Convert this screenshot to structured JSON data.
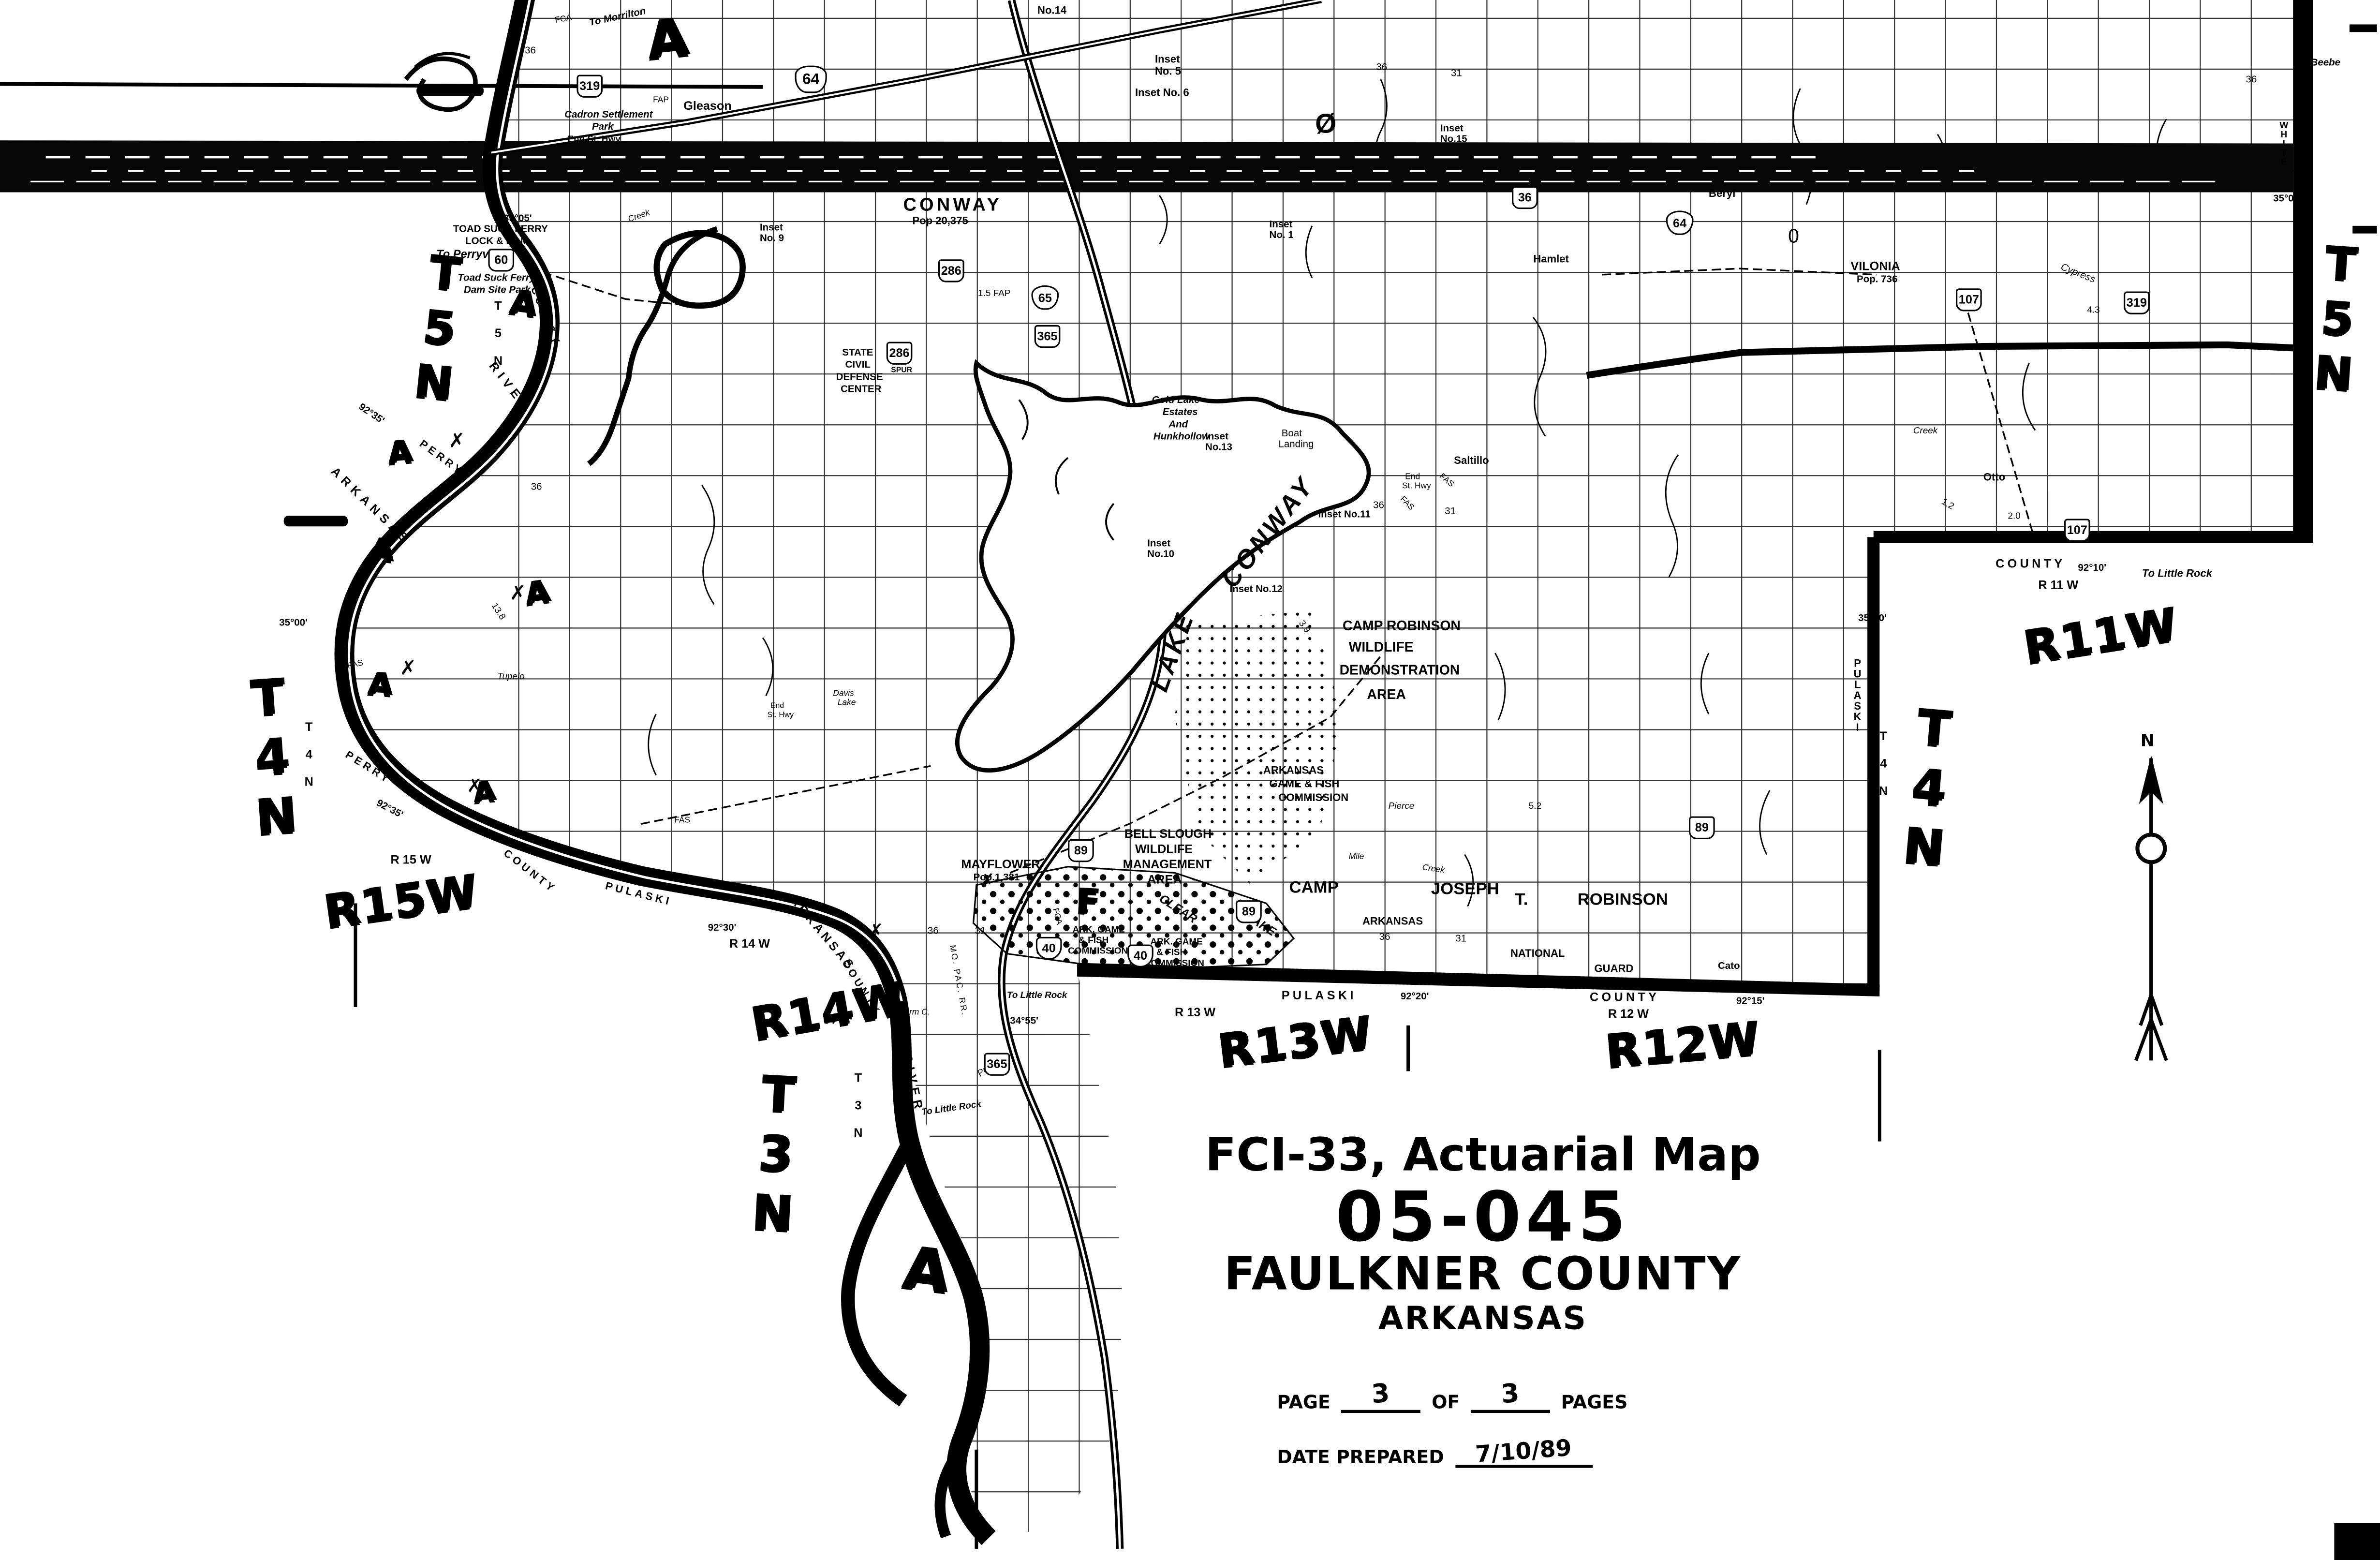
{
  "title_block": {
    "line1": "FCI-33, Actuarial Map",
    "map_number": "05-045",
    "county": "FAULKNER COUNTY",
    "state": "ARKANSAS",
    "page_label": "PAGE",
    "page_current": "3",
    "of_label": "OF",
    "page_total": "3",
    "pages_label": "PAGES",
    "date_label": "DATE PREPARED",
    "date_value": "7/10/89"
  },
  "compass": {
    "north": "N"
  },
  "towns": {
    "conway": "CONWAY",
    "conway_pop": "Pop 20,375",
    "vilonia": "VILONIA",
    "vilonia_pop": "Pop. 736",
    "mayflower": "MAYFLOWER",
    "mayflower_pop": "Pop.1,381",
    "gleason": "Gleason",
    "saltillo": "Saltillo",
    "otto": "Otto",
    "hamlet": "Hamlet",
    "beryl": "Beryl",
    "cato": "Cato"
  },
  "areas": {
    "camp_robinson_wda": [
      "CAMP ROBINSON",
      "WILDLIFE",
      "DEMONSTRATION",
      "AREA"
    ],
    "agfc_lake": [
      "ARKANSAS",
      "GAME & FISH",
      "COMMISSION"
    ],
    "agfc_south": [
      "ARK. GAME",
      "& FISH",
      "COMMISSION"
    ],
    "bell_slough": [
      "BELL SLOUGH",
      "WILDLIFE",
      "MANAGEMENT",
      "AREA"
    ],
    "camp_joseph": {
      "camp": "CAMP",
      "joseph": "JOSEPH",
      "t": "T.",
      "robinson": "ROBINSON",
      "arkansas": "ARKANSAS",
      "national": "NATIONAL",
      "guard": "GUARD"
    },
    "state_civil_defense": [
      "STATE",
      "CIVIL",
      "DEFENSE",
      "CENTER"
    ],
    "gold_lake": [
      "Gold Lake",
      "Estates",
      "And",
      "Hunkhollow"
    ],
    "cadron": [
      "Cadron Settlement",
      "Park"
    ],
    "toad_suck": [
      "TOAD SUCK FERRY",
      "LOCK & DAM"
    ],
    "toad_suck_park": [
      "Toad Suck Ferry",
      "Dam Site Park"
    ],
    "boat_landing": [
      "Boat",
      "Landing"
    ],
    "davis_lake": [
      "Davis",
      "Lake"
    ],
    "end_st_hwy2": [
      "End",
      "St. Hwy"
    ]
  },
  "water": {
    "lake": "LAKE",
    "conway": "CONWAY",
    "clear": "CLEAR",
    "clear_lake_word": "LAKE",
    "arkansas": "ARKANSAS",
    "river": "RIVER",
    "pierce": "Pierce",
    "mile": "Mile",
    "creek": "Creek",
    "palarm": "Palarm",
    "palarm_c": "Palarm C.",
    "tupelo": "Tupelo",
    "cypress": "Cypress"
  },
  "counties": {
    "perry": "PERRY",
    "pulaski": "PULASKI",
    "county": "COUNTY",
    "white": "WHITE"
  },
  "coords": {
    "n3505": "35°05'",
    "n3500": "35°00'",
    "n3455": "34°55'",
    "w9235": "92°35'",
    "w9230": "92°30'",
    "w9220": "92°20'",
    "w9215": "92°15'",
    "w9210": "92°10'"
  },
  "tr_printed": {
    "t5n": "T 5 N",
    "t4n": "T 4 N",
    "t3n": "T 3 N",
    "r15w": "R 15 W",
    "r14w": "R 14 W",
    "r13w": "R 13 W",
    "r12w": "R 12 W",
    "r11w": "R 11 W"
  },
  "tr_hand": {
    "t5n": "T5N",
    "t4n": "T4N",
    "t3n": "T3N",
    "r15w": "R15W",
    "r14w": "R14W",
    "r13w": "R13W",
    "r12w": "R12W",
    "r11w": "R11W"
  },
  "hand_marks": {
    "a": "A",
    "f": "F",
    "x": "✗"
  },
  "insets": {
    "no14": "No.14",
    "no1": [
      "Inset",
      "No. 1"
    ],
    "no5": [
      "Inset",
      "No. 5"
    ],
    "no6": "Inset No. 6",
    "no9": [
      "Inset",
      "No. 9"
    ],
    "no10": [
      "Inset",
      "No.10"
    ],
    "no11": "Inset No.11",
    "no12": "Inset No.12",
    "no13": [
      "Inset",
      "No.13"
    ],
    "no15": [
      "Inset",
      "No.15"
    ]
  },
  "shields": {
    "us64": "64",
    "us65": "65",
    "i40": "40",
    "ar60": "60",
    "ar319": "319",
    "ar286": "286",
    "ar365": "365",
    "ar107": "107",
    "ar36": "36",
    "ar89": "89",
    "spur": "SPUR"
  },
  "notes": {
    "to_morrilton": "To Morrilton",
    "to_beebe": "To Beebe",
    "to_perryville": "To Perryville",
    "to_little_rock": "To Little Rock",
    "end_st_hwy": "End St. Hwy",
    "mo_pac_rr": "MO. PAC. RR.",
    "fas": "FAS",
    "fap": "FAP",
    "fca": "FCA",
    "fap15": "1.5 FAP"
  },
  "numbers": {
    "s36": "36",
    "s31": "31",
    "m20": "2.0",
    "m12": "1.2",
    "m43": "4.3",
    "m39": "3.9",
    "m52": "5.2",
    "m138": "13.8",
    "zero": "Ø",
    "oval": "0"
  }
}
